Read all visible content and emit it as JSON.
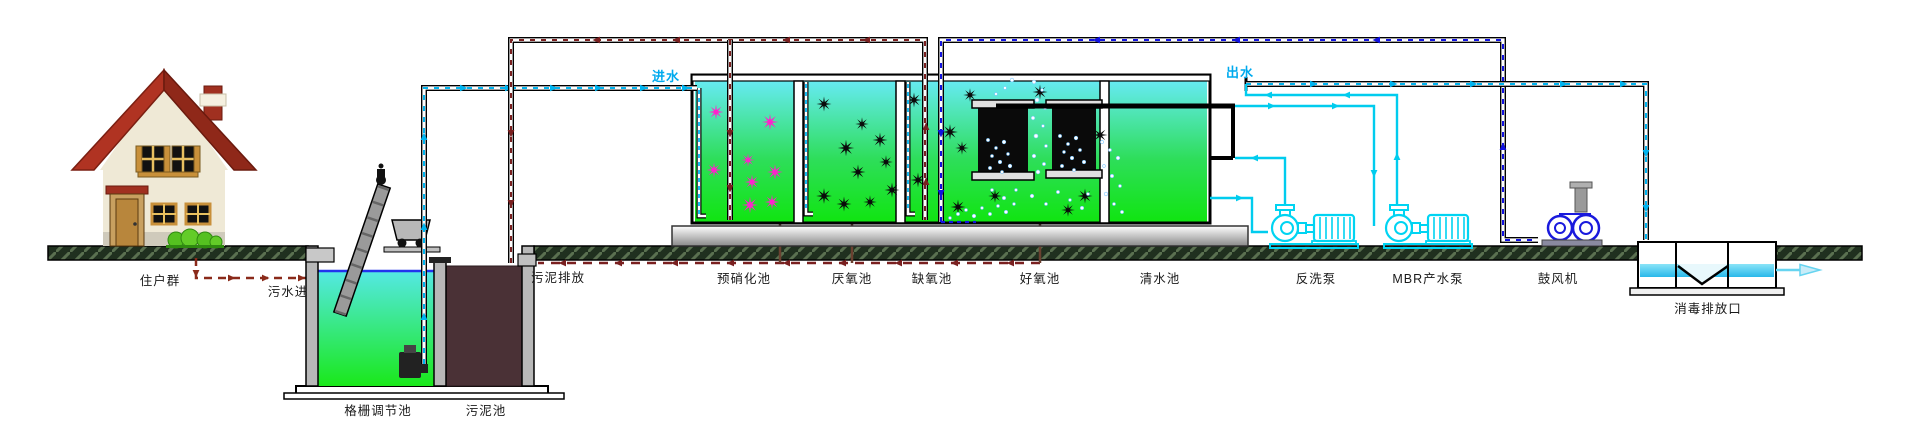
{
  "diagram_title": "MBR wastewater treatment process flow diagram",
  "labels": {
    "residents": "住户群",
    "sewage_in": "污水进",
    "screen_tank": "格栅调节池",
    "sludge_tank": "污泥池",
    "sludge_discharge": "污泥排放",
    "influent": "进水",
    "pre_nitrification_tank": "预硝化池",
    "anaerobic_tank": "厌氧池",
    "anoxic_tank": "缺氧池",
    "aerobic_tank": "好氧池",
    "clear_water_tank": "清水池",
    "effluent": "出水",
    "backwash_pump": "反洗泵",
    "mbr_product_pump": "MBR产水泵",
    "blower": "鼓风机",
    "disinfection_outlet": "消毒排放口"
  },
  "colors": {
    "influent_effluent_line": "#00b4f0",
    "air_line": "#1212e0",
    "sludge_line": "#7a2020",
    "sewage_line": "#8a2a1a",
    "pump_outline": "#00d4f2",
    "water_gradient_top": "#66eaf2",
    "water_gradient_bottom": "#10e510",
    "floc_pink": "#ff22cc",
    "floc_black": "#0a0a0a",
    "sludge_fill": "#4a3136",
    "roof_red": "#b03322"
  }
}
